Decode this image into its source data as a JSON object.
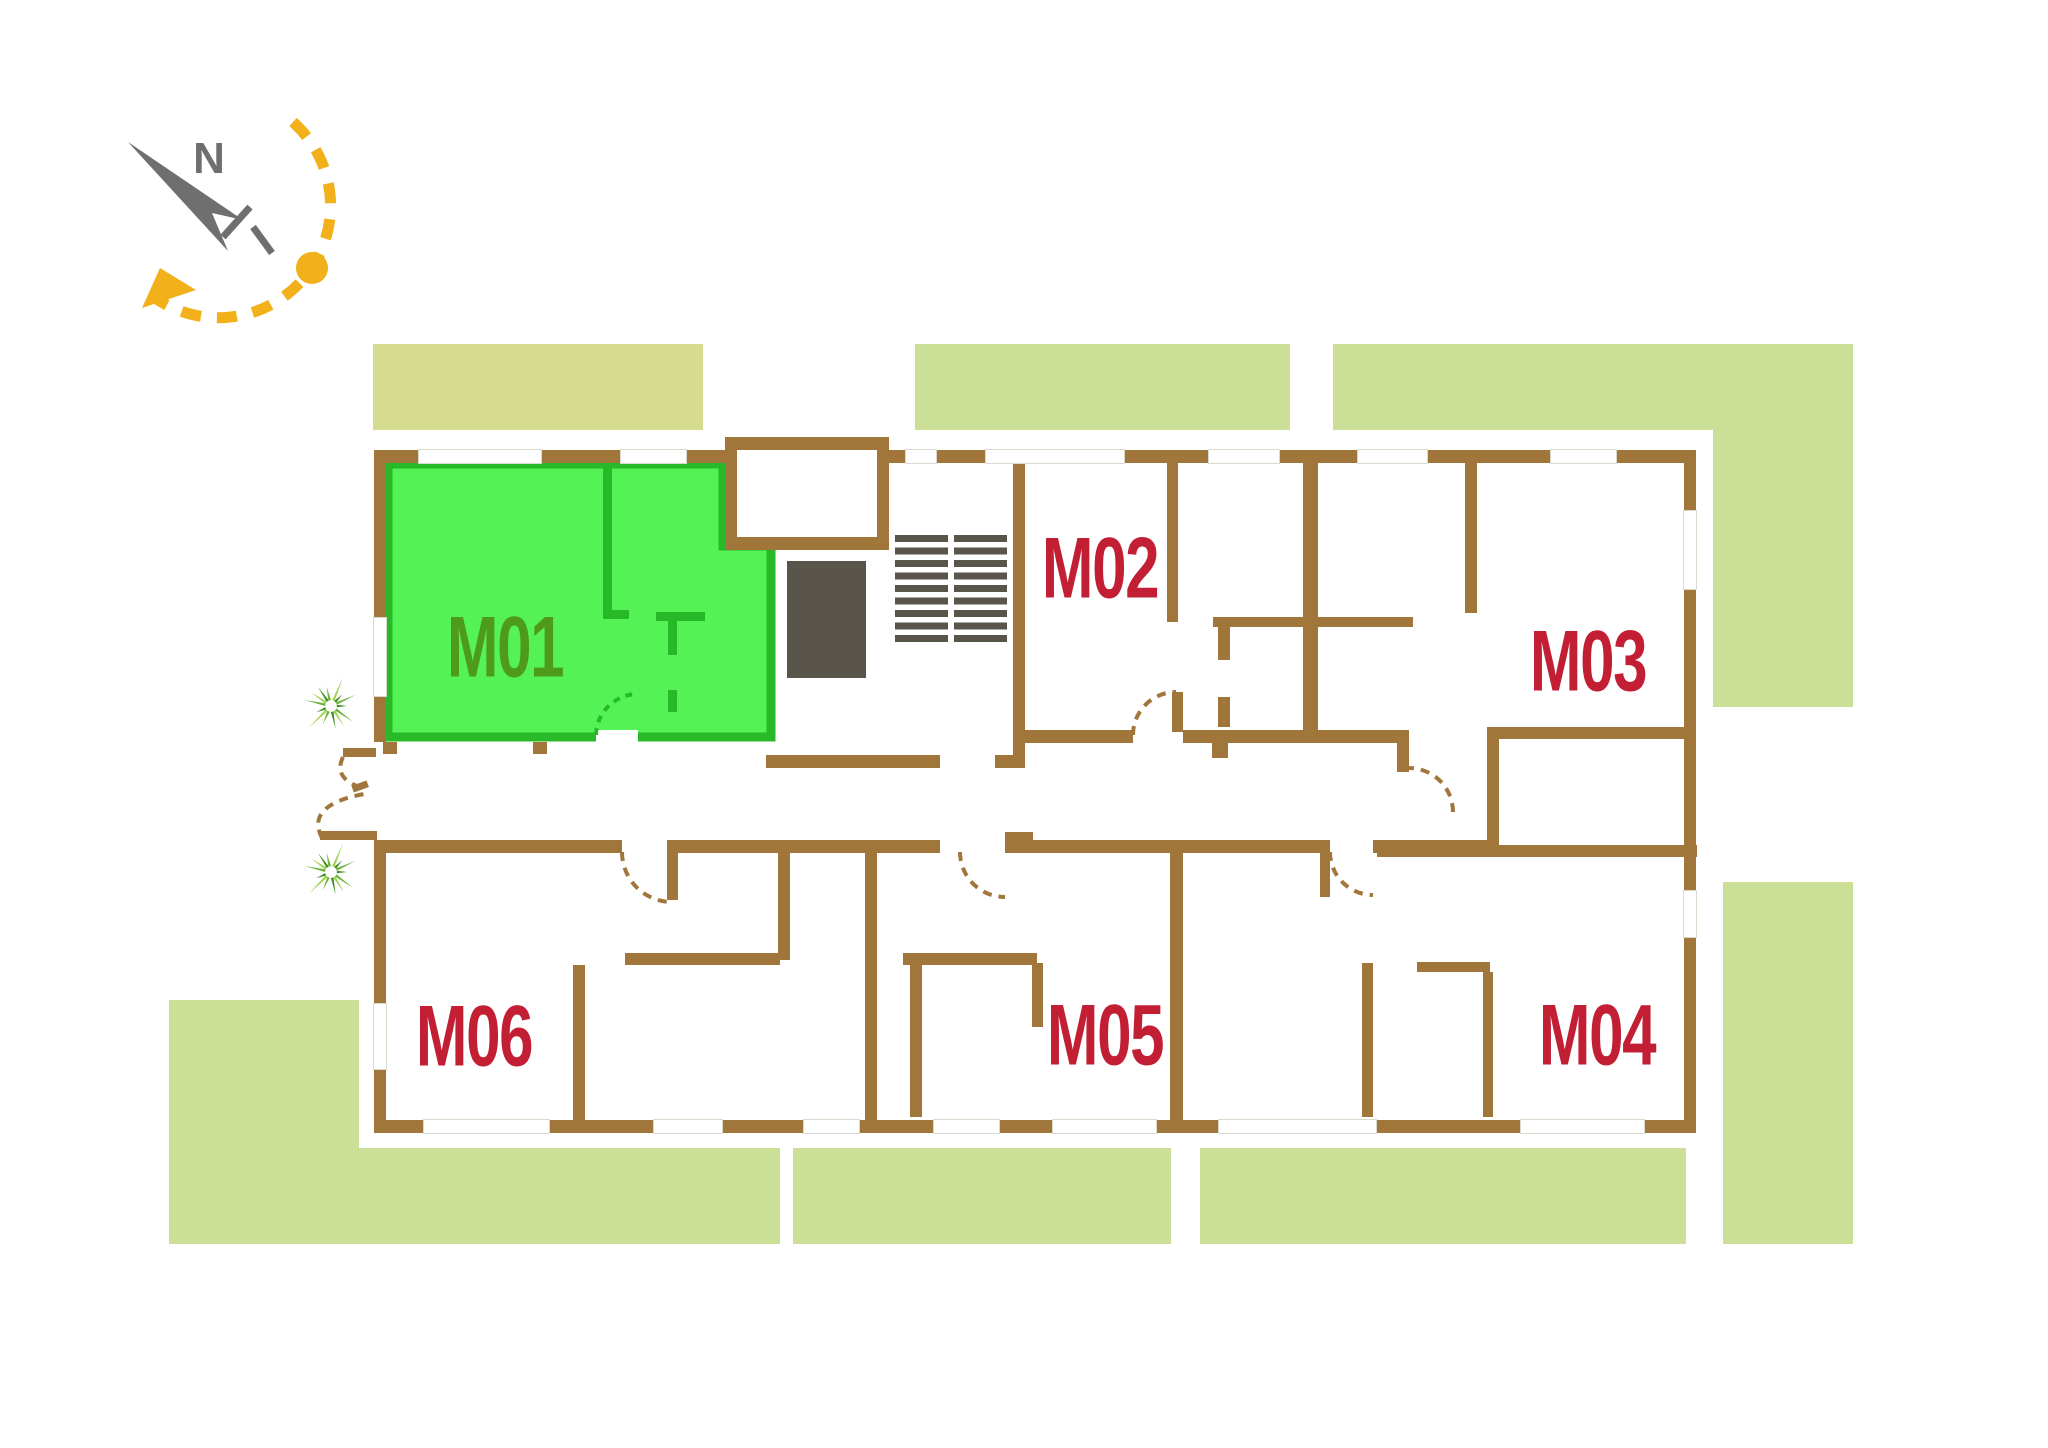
{
  "compass": {
    "north_label": "N"
  },
  "palette": {
    "wall": "#a0763b",
    "lawn_a": "#d6dc8f",
    "lawn_b": "#cbe096",
    "unit_fill": "#55f255",
    "unit_border": "#28b928",
    "unit_label": "#4e9a1a",
    "red": "#c21f35",
    "gray": "#59554a",
    "compass_gray": "#6f6f6f",
    "yellow": "#f2b11b",
    "window_border": "#d9d9cc",
    "plant_dark": "#3f8d21",
    "plant_mid": "#6db33f",
    "plant_light": "#9ed44e"
  },
  "units": [
    {
      "id": "m01",
      "label": "M01",
      "x": 505,
      "y": 648,
      "highlighted": true
    },
    {
      "id": "m02",
      "label": "M02",
      "x": 1100,
      "y": 569,
      "highlighted": false
    },
    {
      "id": "m03",
      "label": "M03",
      "x": 1588,
      "y": 662,
      "highlighted": false
    },
    {
      "id": "m04",
      "label": "M04",
      "x": 1597,
      "y": 1036,
      "highlighted": false
    },
    {
      "id": "m05",
      "label": "M05",
      "x": 1105,
      "y": 1036,
      "highlighted": false
    },
    {
      "id": "m06",
      "label": "M06",
      "x": 474,
      "y": 1037,
      "highlighted": false
    }
  ],
  "plan": {
    "lawns": {
      "a": [
        [
          373,
          344,
          330,
          86
        ]
      ],
      "b": [
        [
          915,
          344,
          375,
          86
        ],
        [
          1333,
          344,
          520,
          86
        ],
        [
          1713,
          344,
          140,
          363
        ],
        [
          1723,
          882,
          130,
          362
        ],
        [
          169,
          1000,
          409,
          244
        ],
        [
          359,
          1148,
          421,
          96
        ],
        [
          793,
          1148,
          378,
          96
        ],
        [
          1200,
          1148,
          486,
          96
        ]
      ]
    },
    "underlay": [
      [
        359,
        435,
        1352,
        713
      ],
      [
        710,
        422,
        194,
        41
      ]
    ],
    "walls": [
      [
        374,
        450,
        44,
        13
      ],
      [
        542,
        450,
        78,
        13
      ],
      [
        687,
        450,
        40,
        13
      ],
      [
        725,
        437,
        164,
        13
      ],
      [
        725,
        437,
        12,
        113
      ],
      [
        877,
        437,
        12,
        113
      ],
      [
        737,
        537,
        152,
        13
      ],
      [
        889,
        450,
        16,
        13
      ],
      [
        937,
        450,
        48,
        13
      ],
      [
        1125,
        450,
        83,
        13
      ],
      [
        1280,
        450,
        77,
        13
      ],
      [
        1428,
        450,
        122,
        13
      ],
      [
        1617,
        450,
        79,
        13
      ],
      [
        374,
        450,
        12,
        167
      ],
      [
        374,
        697,
        12,
        45
      ],
      [
        374,
        840,
        12,
        163
      ],
      [
        374,
        1070,
        12,
        63
      ],
      [
        1684,
        450,
        12,
        60
      ],
      [
        1684,
        590,
        12,
        300
      ],
      [
        1684,
        938,
        12,
        195
      ],
      [
        374,
        1120,
        49,
        13
      ],
      [
        550,
        1120,
        103,
        13
      ],
      [
        723,
        1120,
        80,
        13
      ],
      [
        860,
        1120,
        73,
        13
      ],
      [
        1000,
        1120,
        52,
        13
      ],
      [
        1157,
        1120,
        61,
        13
      ],
      [
        1377,
        1120,
        143,
        13
      ],
      [
        1645,
        1120,
        51,
        13
      ],
      [
        1013,
        450,
        12,
        305
      ],
      [
        766,
        755,
        174,
        13
      ],
      [
        995,
        755,
        30,
        13
      ],
      [
        1025,
        730,
        108,
        13
      ],
      [
        1172,
        692,
        11,
        40
      ],
      [
        1183,
        730,
        214,
        13
      ],
      [
        1397,
        730,
        12,
        42
      ],
      [
        1487,
        727,
        12,
        130
      ],
      [
        1493,
        727,
        203,
        12
      ],
      [
        1303,
        463,
        15,
        267
      ],
      [
        1167,
        463,
        11,
        159
      ],
      [
        1213,
        617,
        90,
        10
      ],
      [
        1318,
        617,
        95,
        10
      ],
      [
        1218,
        627,
        12,
        33
      ],
      [
        1218,
        697,
        12,
        30
      ],
      [
        1465,
        463,
        12,
        150
      ],
      [
        374,
        840,
        248,
        13
      ],
      [
        667,
        840,
        273,
        13
      ],
      [
        1005,
        840,
        325,
        13
      ],
      [
        1373,
        840,
        114,
        13
      ],
      [
        1377,
        845,
        320,
        12
      ],
      [
        865,
        853,
        12,
        280
      ],
      [
        1170,
        842,
        13,
        291
      ],
      [
        667,
        852,
        11,
        48
      ],
      [
        1005,
        832,
        28,
        9
      ],
      [
        1320,
        852,
        10,
        45
      ],
      [
        625,
        953,
        155,
        12
      ],
      [
        573,
        965,
        12,
        155
      ],
      [
        778,
        853,
        12,
        107
      ],
      [
        903,
        953,
        134,
        12
      ],
      [
        910,
        963,
        12,
        154
      ],
      [
        1032,
        963,
        11,
        64
      ],
      [
        1362,
        963,
        11,
        154
      ],
      [
        1417,
        962,
        73,
        10
      ],
      [
        1483,
        972,
        10,
        145
      ],
      [
        533,
        742,
        14,
        12
      ],
      [
        1212,
        742,
        16,
        16
      ],
      [
        383,
        742,
        14,
        12
      ],
      [
        343,
        748,
        33,
        9
      ],
      [
        320,
        831,
        57,
        9
      ]
    ],
    "windows": [
      [
        418,
        449,
        124,
        15
      ],
      [
        620,
        449,
        67,
        15
      ],
      [
        905,
        449,
        32,
        15
      ],
      [
        985,
        449,
        140,
        15
      ],
      [
        1208,
        449,
        72,
        15
      ],
      [
        1357,
        449,
        71,
        15
      ],
      [
        1550,
        449,
        67,
        15
      ],
      [
        373,
        617,
        14,
        80
      ],
      [
        373,
        1003,
        14,
        67
      ],
      [
        1683,
        510,
        14,
        80
      ],
      [
        1683,
        890,
        14,
        48
      ],
      [
        423,
        1119,
        127,
        15
      ],
      [
        653,
        1119,
        70,
        15
      ],
      [
        803,
        1119,
        57,
        15
      ],
      [
        933,
        1119,
        67,
        15
      ],
      [
        1052,
        1119,
        105,
        15
      ],
      [
        1218,
        1119,
        159,
        15
      ],
      [
        1520,
        1119,
        125,
        15
      ]
    ],
    "stairs": [
      [
        895,
        535,
        53,
        112
      ],
      [
        954,
        535,
        53,
        112
      ]
    ],
    "elevator": [
      787,
      561,
      79,
      117
    ],
    "unit_polygon": "388,464 723,464 723,546 771,546 771,737 388,737",
    "unit_inner_walls": [
      [
        603,
        468,
        9,
        146
      ],
      [
        603,
        610,
        26,
        9
      ],
      [
        656,
        612,
        49,
        9
      ],
      [
        668,
        621,
        9,
        34
      ],
      [
        668,
        690,
        9,
        22
      ]
    ],
    "unit_door_gap": [
      596,
      730,
      42,
      13
    ],
    "arc_green": "M 596,735 A 42 42 0 0 1 637,694",
    "arcs_brown": [
      "M 343,757 Q 332,780 366,789",
      "M 322,838 Q 305,805 364,794",
      "M 1133,735 A 43 43 0 0 1 1176,692",
      "M 1453,812 A 44 44 0 0 0 1409,768",
      "M 622,852 A 50 50 0 0 0 672,902",
      "M 960,852 A 45 45 0 0 0 1005,897",
      "M 1330,852 A 43 43 0 0 0 1373,895"
    ],
    "plants": [
      [
        331,
        706
      ],
      [
        331,
        872
      ]
    ]
  }
}
